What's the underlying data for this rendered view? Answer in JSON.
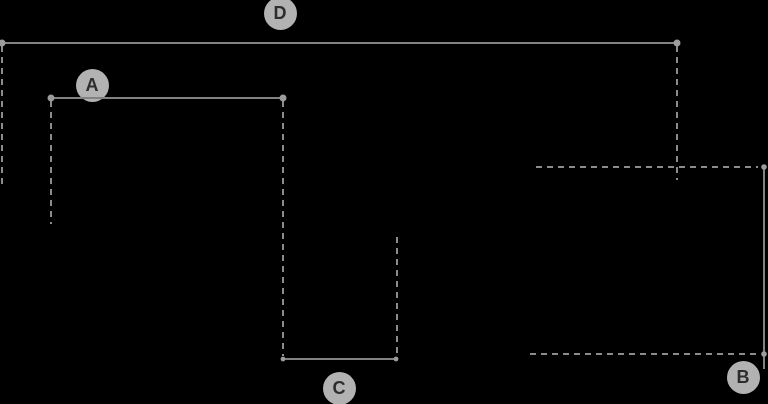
{
  "diagram": {
    "description": "dimension-annotation-overlay",
    "canvas": {
      "width": 768,
      "height": 404,
      "background": "#000000"
    },
    "colors": {
      "solid_line": "#828282",
      "dashed_line": "#8c8c8c",
      "endpoint_dot": "#9c9c9c",
      "badge_fill": "#b2b2b2",
      "badge_text": "#2d2d2d"
    },
    "dash_pattern": "6 5",
    "line_width": 2,
    "dimension_lines": [
      {
        "label": "D",
        "orientation": "horizontal",
        "x1": 0,
        "y1": 43,
        "x2": 677,
        "y2": 43,
        "dots": [
          {
            "x": 2,
            "y": 43,
            "r": 3.5
          },
          {
            "x": 677,
            "y": 43,
            "r": 3.5
          }
        ],
        "badge": {
          "cx": 280,
          "cy": 13
        }
      },
      {
        "label": "A",
        "orientation": "horizontal",
        "x1": 51,
        "y1": 98,
        "x2": 283,
        "y2": 98,
        "dots": [
          {
            "x": 51,
            "y": 98,
            "r": 3.5
          },
          {
            "x": 283,
            "y": 98,
            "r": 3.5
          }
        ],
        "badge": {
          "cx": 92,
          "cy": 85
        }
      },
      {
        "label": "C",
        "orientation": "horizontal",
        "x1": 282,
        "y1": 359,
        "x2": 397,
        "y2": 359,
        "dots": [
          {
            "x": 283,
            "y": 359,
            "r": 2.4
          },
          {
            "x": 396,
            "y": 359,
            "r": 2.4
          }
        ],
        "badge": {
          "cx": 339,
          "cy": 388
        }
      },
      {
        "label": "B",
        "orientation": "vertical",
        "x1": 764,
        "y1": 167,
        "x2": 764,
        "y2": 369,
        "dots": [
          {
            "x": 764,
            "y": 167,
            "r": 2.8
          },
          {
            "x": 764,
            "y": 354,
            "r": 2.8
          }
        ],
        "badge": {
          "cx": 743,
          "cy": 377
        }
      }
    ],
    "extension_lines": [
      {
        "orientation": "vertical",
        "x1": 2,
        "y1": 46,
        "x2": 2,
        "y2": 185
      },
      {
        "orientation": "vertical",
        "x1": 51,
        "y1": 101,
        "x2": 51,
        "y2": 224
      },
      {
        "orientation": "vertical",
        "x1": 283,
        "y1": 101,
        "x2": 283,
        "y2": 356
      },
      {
        "orientation": "vertical",
        "x1": 677,
        "y1": 46,
        "x2": 677,
        "y2": 180
      },
      {
        "orientation": "vertical",
        "x1": 397,
        "y1": 237,
        "x2": 397,
        "y2": 356
      },
      {
        "orientation": "horizontal",
        "x1": 536,
        "y1": 167,
        "x2": 758,
        "y2": 167
      },
      {
        "orientation": "horizontal",
        "x1": 530,
        "y1": 354,
        "x2": 760,
        "y2": 354
      }
    ]
  }
}
